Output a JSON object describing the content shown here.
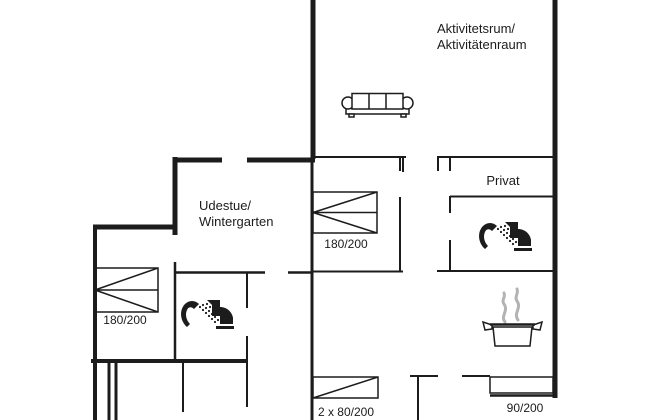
{
  "figure": {
    "type": "floor-plan",
    "description": "Holiday house floor plan",
    "background_color": "#ffffff",
    "wall_color": "#1c1c1c",
    "steam_color": "#b3b3b3"
  },
  "rooms": {
    "activity_room": {
      "line1": "Aktivitetsrum/",
      "line2": "Aktivitätenraum"
    },
    "winter_garden": {
      "line1": "Udestue/",
      "line2": "Wintergarten"
    },
    "private_room": {
      "label": "Privat"
    }
  },
  "beds": {
    "bedroom_middle": {
      "size": "180/200"
    },
    "bedroom_left": {
      "size": "180/200"
    },
    "bedroom_bottom": {
      "size": "2 x 80/200"
    },
    "bed_alcove": {
      "size": "90/200"
    }
  },
  "furniture_icons": [
    {
      "name": "sofa-icon",
      "room": "activity_room"
    },
    {
      "name": "shower-icon",
      "room": "bathroom_right"
    },
    {
      "name": "toilet-icon",
      "room": "bathroom_right"
    },
    {
      "name": "shower-icon",
      "room": "bathroom_left"
    },
    {
      "name": "toilet-icon",
      "room": "bathroom_left"
    },
    {
      "name": "cooking-pot-icon",
      "room": "kitchen"
    }
  ]
}
